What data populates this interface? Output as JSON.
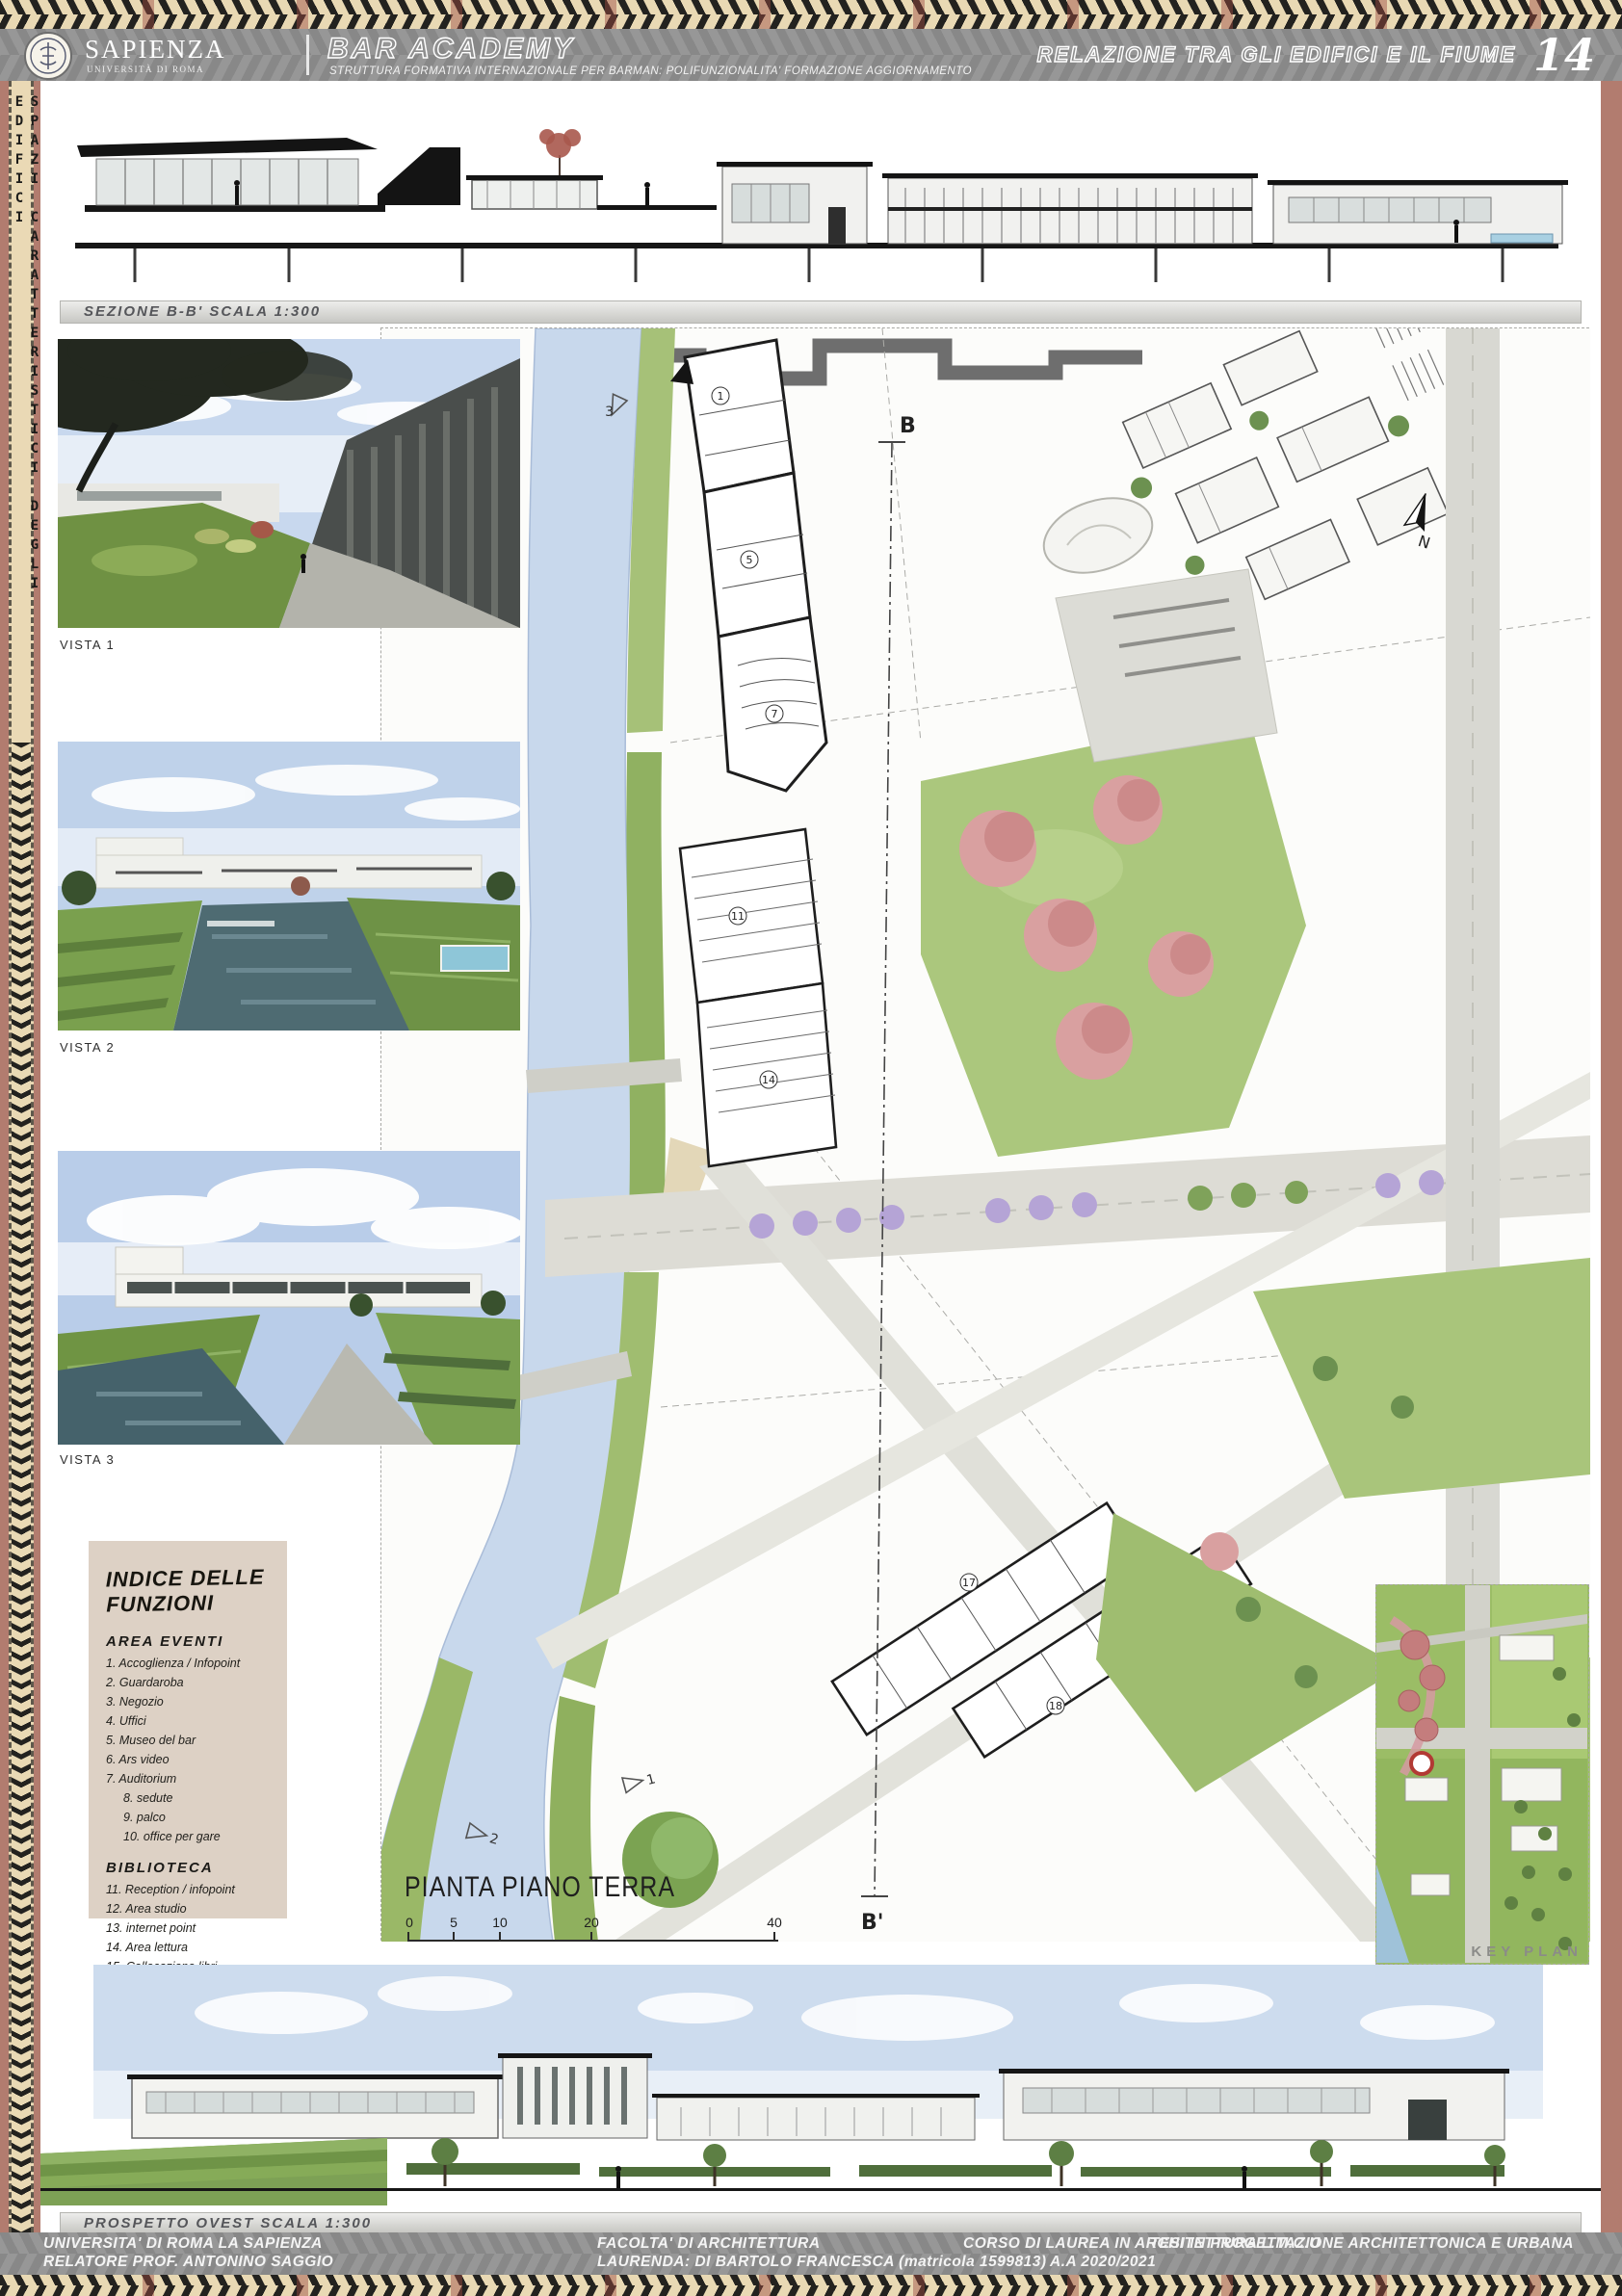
{
  "palette": {
    "band_cream": "#e9d9b4",
    "band_black": "#23221f",
    "accent_rust": "#9c4a40",
    "side_rose": "#b27c6f",
    "header_gray": "#8f8f8f",
    "river_blue": "#c8d8ec",
    "park_green": "#abc77d",
    "legend_beige": "#ddd1c5",
    "tree_pink": "#d9a0a0",
    "tree_purple": "#b5a4d6"
  },
  "header": {
    "university_name": "SAPIENZA",
    "university_subtitle": "UNIVERSITÀ DI ROMA",
    "project_title": "BAR ACADEMY",
    "project_subtitle": "STRUTTURA FORMATIVA INTERNAZIONALE PER BARMAN: POLIFUNZIONALITA' FORMAZIONE AGGIORNAMENTO",
    "sheet_title": "RELAZIONE TRA GLI EDIFICI E IL FIUME",
    "sheet_number": "14"
  },
  "sidebar": {
    "vertical_title": "SPAZI CARATTERISTICI DEGLI EDIFICI"
  },
  "section": {
    "label": "SEZIONE B-B' SCALA 1:300"
  },
  "views": {
    "v1_label": "VISTA 1",
    "v2_label": "VISTA 2",
    "v3_label": "VISTA 3"
  },
  "legend": {
    "title": "INDICE DELLE FUNZIONI",
    "group1_heading": "AREA EVENTI",
    "group1_items": [
      "1. Accoglienza / Infopoint",
      "2. Guardaroba",
      "3. Negozio",
      "4. Uffici",
      "5. Museo del bar",
      "6. Ars video",
      "7. Auditorium"
    ],
    "group1_subitems": [
      "8. sedute",
      "9. palco",
      "10. office per gare"
    ],
    "group2_heading": "BIBLIOTECA",
    "group2_items": [
      "11. Reception / infopoint",
      "12. Area studio",
      "13. internet point",
      "14. Area lettura",
      "15. Collocazione libri",
      "16. Emeroteca"
    ],
    "group3_heading": "ATTIVITA' COMMERCIALI",
    "group3_items": [
      "17. Bar",
      "18. Negozi"
    ]
  },
  "plan": {
    "label": "PIANTA PIANO TERRA",
    "scale_ticks": [
      "0",
      "5",
      "10",
      "20",
      "40"
    ],
    "markers": {
      "section_start": "B",
      "section_end": "B'",
      "north": "N",
      "view1": "1",
      "view2": "2",
      "view3": "3"
    },
    "function_numbers": [
      "1",
      "5",
      "7",
      "11",
      "14",
      "17",
      "18"
    ]
  },
  "keyplan": {
    "label": "KEY PLAN"
  },
  "elevation": {
    "label": "PROSPETTO OVEST SCALA 1:300"
  },
  "footer": {
    "line1": [
      "UNIVERSITA' DI ROMA LA SAPIENZA",
      "FACOLTA' DI ARCHITETTURA",
      "CORSO DI LAUREA IN ARCHITETTURA L.M.C.U",
      "TESI IN PROGETTAZIONE ARCHITETTONICA E URBANA"
    ],
    "line2": [
      "RELATORE PROF. ANTONINO SAGGIO",
      "LAURENDA: DI BARTOLO FRANCESCA (matricola 1599813)",
      "A.A 2020/2021"
    ]
  }
}
